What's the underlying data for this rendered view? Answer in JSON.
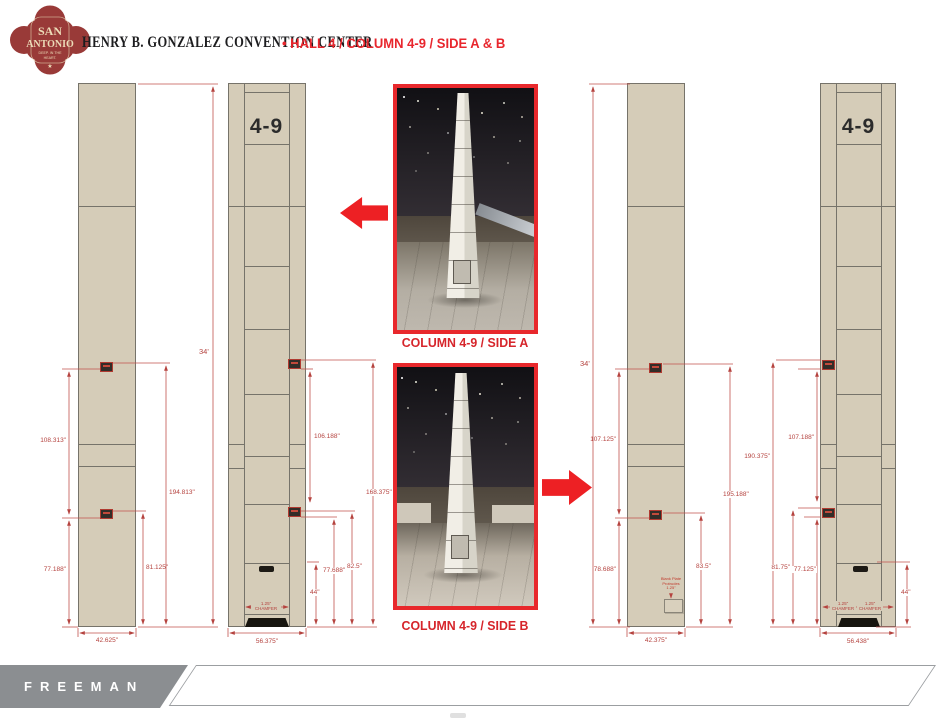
{
  "header": {
    "logo": {
      "line1": "SAN",
      "line2": "ANTONIO",
      "tag1": "DEEP. IN THE",
      "tag2": "HEART.",
      "star": "★"
    },
    "title": "HENRY B. GONZALEZ CONVENTION CENTER",
    "bullet": "•",
    "subtitle": "HALL 4 / COLUMN 4-9 / SIDE A & B"
  },
  "drawing": {
    "column_id": "4-9",
    "overall_height": "34'",
    "col1": {
      "side": "A",
      "type": "narrow",
      "dim_upper_left": "108.313\"",
      "dim_lower_left": "77.188\"",
      "dim_right": "194.813\"",
      "dim_inner_right": "81.125\"",
      "width": "42.625\""
    },
    "col2": {
      "side": "A",
      "type": "wide",
      "dim_upper": "106.188\"",
      "dim_full": "168.375\"",
      "dim_lower": "77.688\"",
      "dim_lower2": "82.5\"",
      "dim_base": "44\"",
      "chamfer_value": "1.25\"",
      "chamfer_word": "CHAMFER",
      "width": "56.375\""
    },
    "col3": {
      "side": "B",
      "type": "narrow",
      "dim_upper_left": "107.125\"",
      "dim_lower_left": "78.688\"",
      "dim_right": "195.188\"",
      "dim_inner_right": "83.5\"",
      "width": "42.375\"",
      "note_line1": "Blank Plate",
      "note_line2": "Protrudes",
      "note_line3": "1.25\""
    },
    "col4": {
      "side": "B",
      "type": "wide",
      "dim_full": "190.375\"",
      "dim_upper": "107.188\"",
      "dim_lower": "81.75\"",
      "dim_lower2": "77.125\"",
      "dim_base": "44\"",
      "chamfer_value": "1.25\"",
      "chamfer_word": "CHAMFER",
      "width": "56.438\""
    }
  },
  "photos": {
    "a_caption": "COLUMN 4-9 / SIDE A",
    "b_caption": "COLUMN 4-9 / SIDE B"
  },
  "footer": {
    "brand": "FREEMAN"
  },
  "colors": {
    "accent_red": "#e8262d",
    "dim_red": "#b5433f",
    "column_tan": "#d5ccb8",
    "logo_red": "#993a38",
    "footer_gray": "#8b8e91"
  }
}
